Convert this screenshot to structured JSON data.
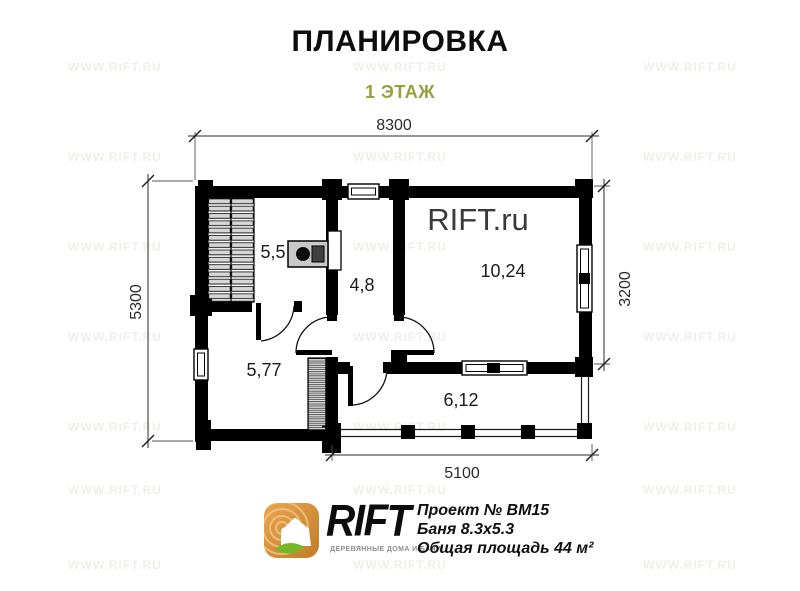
{
  "page": {
    "title": "ПЛАНИРОВКА",
    "subtitle": "1 ЭТАЖ"
  },
  "plan": {
    "watermark": "RIFT.ru",
    "dimensions": {
      "top": "8300",
      "left": "5300",
      "right": "3200",
      "bottom": "5100"
    },
    "rooms": [
      {
        "name": "steam-room",
        "area": "5,5"
      },
      {
        "name": "hallway",
        "area": "4,8"
      },
      {
        "name": "rest-room",
        "area": "10,24"
      },
      {
        "name": "washing-room",
        "area": "5,77"
      },
      {
        "name": "terrace",
        "area": "6,12"
      }
    ]
  },
  "footer": {
    "logo_text": "RIFT",
    "logo_tagline": "ДЕРЕВЯННЫЕ ДОМА И БАНИ",
    "project_lines": [
      "Проект № ВМ15",
      "Баня 8.3х5.3",
      "Общая площадь 44 м²"
    ]
  },
  "watermark_tile": "WWW.RIFT.RU",
  "colors": {
    "accent_green": "#97a13c",
    "logo_orange": "#dd9436",
    "logo_orange_dark": "#c27c28",
    "leaf_green": "#76b82a",
    "wall_black": "#000000",
    "bench_gray": "#d6d6d6",
    "stove_gray": "#c9c9c9"
  }
}
